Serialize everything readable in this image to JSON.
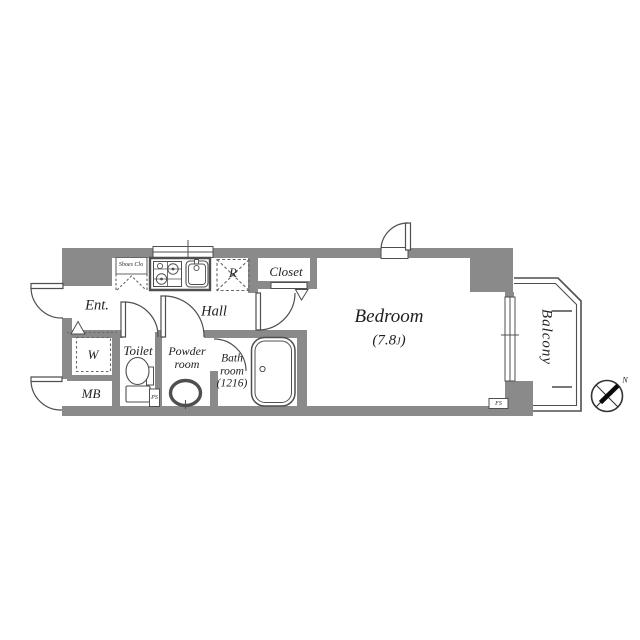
{
  "colors": {
    "wall": "#8a8a8a",
    "line": "#4f4f4f",
    "thin": "#666666",
    "text": "#1f1f1f",
    "needle": "#0a0a0a"
  },
  "labels": {
    "entrance": "Ent.",
    "hall": "Hall",
    "shoes_closet": "Shoes Clo",
    "refrigerator": "R",
    "closet": "Closet",
    "bedroom": "Bedroom",
    "bedroom_size_open": "(7.8",
    "bedroom_size_unit": "J",
    "bedroom_size_close": ")",
    "washing_machine": "W",
    "meter_box": "MB",
    "toilet": "Toilet",
    "powder_line1": "Powder",
    "powder_line2": "room",
    "bath_line1": "Bath",
    "bath_line2": "room",
    "bath_line3": "(1216)",
    "balcony": "Balcony",
    "pipe_space": "PS",
    "fs_shaft": "FS",
    "north": "N"
  }
}
